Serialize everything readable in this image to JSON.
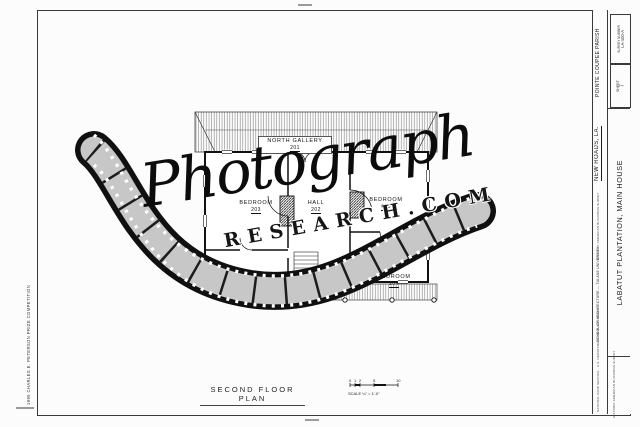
{
  "watermark": {
    "line1": "Photograph",
    "line2": "RESEARCH.COM"
  },
  "title_block": {
    "parish": "POINTE COUPEE PARISH",
    "city": "NEW ROADS, LA.",
    "structure_name": "LABATUT PLANTATION, MAIN HOUSE",
    "survey_label": "SURVEY NUMBER",
    "survey_number": "LA-100-A",
    "sheet_label": "SHEET",
    "sheet_number": "7",
    "credit_note": "HISTORIC AMERICAN BUILDINGS SURVEY",
    "school_note": "SCHOOL OF ARCHITECTURE — TULANE UNIVERSITY",
    "reference_note": "NATIONAL PARK SERVICE · U.S. DEPARTMENT OF THE INTERIOR"
  },
  "margins": {
    "competition_note": "1995 CHARLES E. PETERSON PRIZE COMPETITION"
  },
  "plan": {
    "caption": "SECOND FLOOR PLAN",
    "rooms": [
      {
        "name": "NORTH GALLERY",
        "number": "201"
      },
      {
        "name": "BEDROOM",
        "number": "203"
      },
      {
        "name": "HALL",
        "number": "202"
      },
      {
        "name": "BEDROOM",
        "number": "205"
      },
      {
        "name": "BEDROOM",
        "number": "204"
      }
    ],
    "scale_bar": {
      "label": "SCALE",
      "ratio": "¼\" = 1'-0\"",
      "ticks": [
        "0",
        "1",
        "2",
        "5",
        "10"
      ]
    }
  }
}
